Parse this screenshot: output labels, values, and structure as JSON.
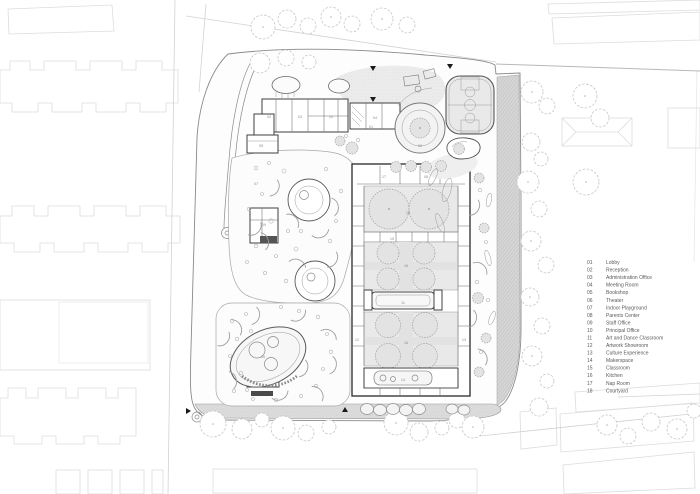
{
  "legend": {
    "items": [
      {
        "num": "01",
        "label": "Lobby"
      },
      {
        "num": "02",
        "label": "Reception"
      },
      {
        "num": "03",
        "label": "Administration Office"
      },
      {
        "num": "04",
        "label": "Meeting Room"
      },
      {
        "num": "05",
        "label": "Bookshop"
      },
      {
        "num": "06",
        "label": "Theater"
      },
      {
        "num": "07",
        "label": "Indoor Playground"
      },
      {
        "num": "08",
        "label": "Parents Center"
      },
      {
        "num": "09",
        "label": "Staff Office"
      },
      {
        "num": "10",
        "label": "Principal Office"
      },
      {
        "num": "11",
        "label": "Art and Dance Classroom"
      },
      {
        "num": "12",
        "label": "Artwork Showroom"
      },
      {
        "num": "13",
        "label": "Culture Experience"
      },
      {
        "num": "14",
        "label": "Makerspace"
      },
      {
        "num": "15",
        "label": "Classroom"
      },
      {
        "num": "16",
        "label": "Kitchen"
      },
      {
        "num": "17",
        "label": "Nap Room"
      },
      {
        "num": "18",
        "label": "Courtyard"
      }
    ]
  },
  "plan_labels": [
    "01",
    "02",
    "03",
    "10",
    "04",
    "05",
    "06",
    "07",
    "08",
    "17",
    "09",
    "15",
    "18",
    "18",
    "11",
    "12",
    "13",
    "18",
    "14",
    "16"
  ],
  "colors": {
    "paper": "#ffffff",
    "context_line": "#dcdcdc",
    "site_outline": "#8a8a8a",
    "wall": "#3f3f3f",
    "courtyard_fill": "#e9e9e9",
    "tree_stroke": "#c6c6c6",
    "legend_text": "#5a5a5a",
    "entrance_marker": "#1a1a1a"
  }
}
